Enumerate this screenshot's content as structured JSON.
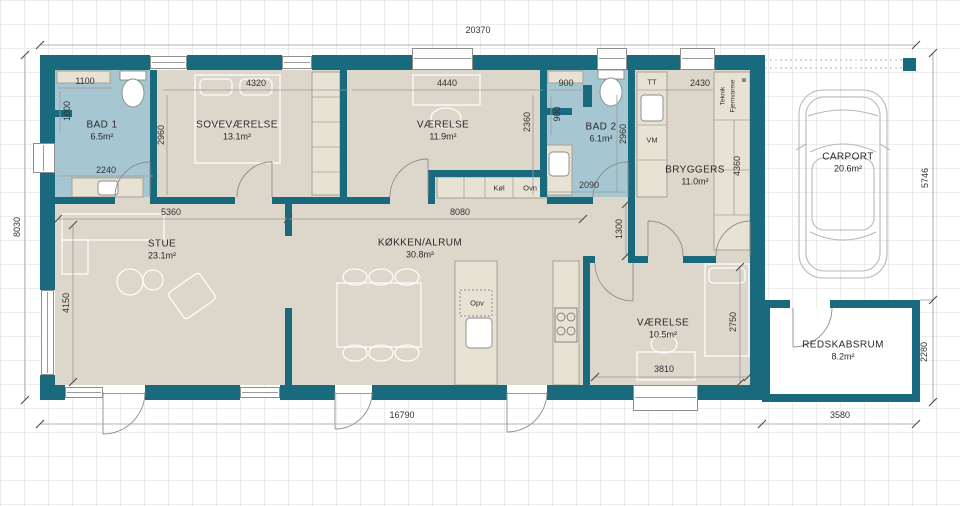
{
  "rooms": {
    "bad1": {
      "name": "BAD 1",
      "area": "6.5m²"
    },
    "sovevaerelse": {
      "name": "SOVEVÆRELSE",
      "area": "13.1m²"
    },
    "vaerelse1": {
      "name": "VÆRELSE",
      "area": "11.9m²"
    },
    "bad2": {
      "name": "BAD 2",
      "area": "6.1m²"
    },
    "bryggers": {
      "name": "BRYGGERS",
      "area": "11.0m²"
    },
    "carport": {
      "name": "CARPORT",
      "area": "20.6m²"
    },
    "stue": {
      "name": "STUE",
      "area": "23.1m²"
    },
    "koekken": {
      "name": "KØKKEN/ALRUM",
      "area": "30.8m²"
    },
    "vaerelse2": {
      "name": "VÆRELSE",
      "area": "10.5m²"
    },
    "redskabsrum": {
      "name": "REDSKABSRUM",
      "area": "8.2m²"
    }
  },
  "dims": {
    "overall_width": "20370",
    "left_height": "8030",
    "carport_depth": "5746",
    "bottom_main": "16790",
    "redskabsrum_width": "3580",
    "redskabsrum_depth": "2280",
    "bad1_top": "1100",
    "bad1_left": "1000",
    "bad1_bottom": "2240",
    "sove_top": "4320",
    "sove_left": "2960",
    "vaer1_top": "4440",
    "vaer1_right": "2360",
    "bad2_nook_w": "900",
    "bad2_nook_h": "900",
    "bad2_right": "2960",
    "bad2_bottom": "2090",
    "bryggers_top": "2430",
    "bryggers_right": "4360",
    "stue_top": "5360",
    "koekken_top": "8080",
    "stue_left": "4150",
    "hall": "1300",
    "vaer2_right": "2750",
    "vaer2_bottom": "3810"
  },
  "labels": {
    "tt": "TT",
    "vm": "VM",
    "teknik": "Teknik",
    "fjernvarme": "Fjernvarme",
    "koel": "Køl",
    "ovn": "Ovn",
    "opv": "Opv"
  },
  "symbols": {
    "district_heating_unit": "⊕"
  },
  "colors": {
    "wall": "#1a6a7d",
    "bath_floor": "#a6c7d1",
    "room_floor": "#dcd7ca"
  }
}
